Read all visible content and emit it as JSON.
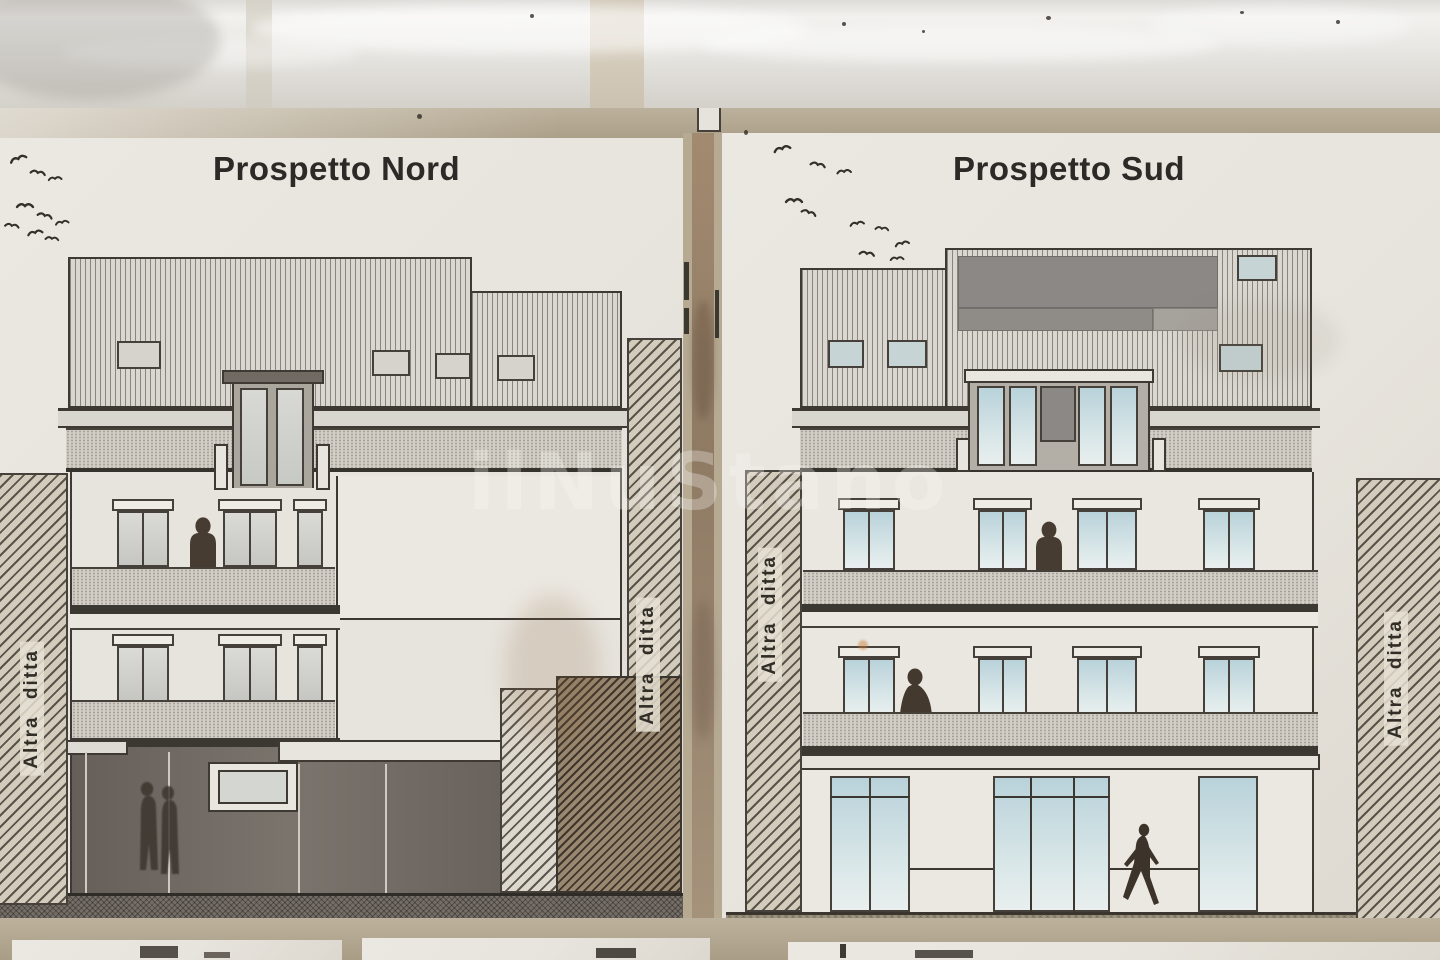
{
  "photo": {
    "subject": "Two architectural elevation drawings photographed under transparent plastic wrap",
    "sheet_count": 2
  },
  "elevations": {
    "north": {
      "title": "Prospetto Nord",
      "adjacent_label_left": "Altra ditta",
      "adjacent_label_right": "Altra ditta",
      "figures": [
        "person standing at upper balcony",
        "two people at dark ground floor"
      ]
    },
    "south": {
      "title": "Prospetto Sud",
      "adjacent_label_left": "Altra ditta",
      "adjacent_label_right": "Altra ditta",
      "figures": [
        "person standing at upper balcony",
        "person seated at lower balcony",
        "person walking at street level"
      ]
    }
  },
  "labels": {
    "adjacent_property": "Altra ditta"
  },
  "watermark": {
    "text": "ilNuStano"
  },
  "decorations": {
    "bird_flocks": 2
  },
  "colors": {
    "photo_background": "#c8c4bd",
    "plastic_highlight": "#f2f1ee",
    "tan_band": "#b3a891",
    "sheet_paper": "#e9e6df",
    "drawing_line": "#3b3731",
    "roof_fill": "#dad7d0",
    "solar_panel_dark": "#8b8885",
    "window_glass_south": "#c3d7dd",
    "window_glass_north": "#d4d4d0",
    "storefront_shadow": "#6e6761",
    "ground_texture_north": "#756e67",
    "ground_texture_south": "#9a907c",
    "hatch_fill": "#d3ccbc",
    "silhouette": "#44392f",
    "title_text": "#2c2a27"
  }
}
